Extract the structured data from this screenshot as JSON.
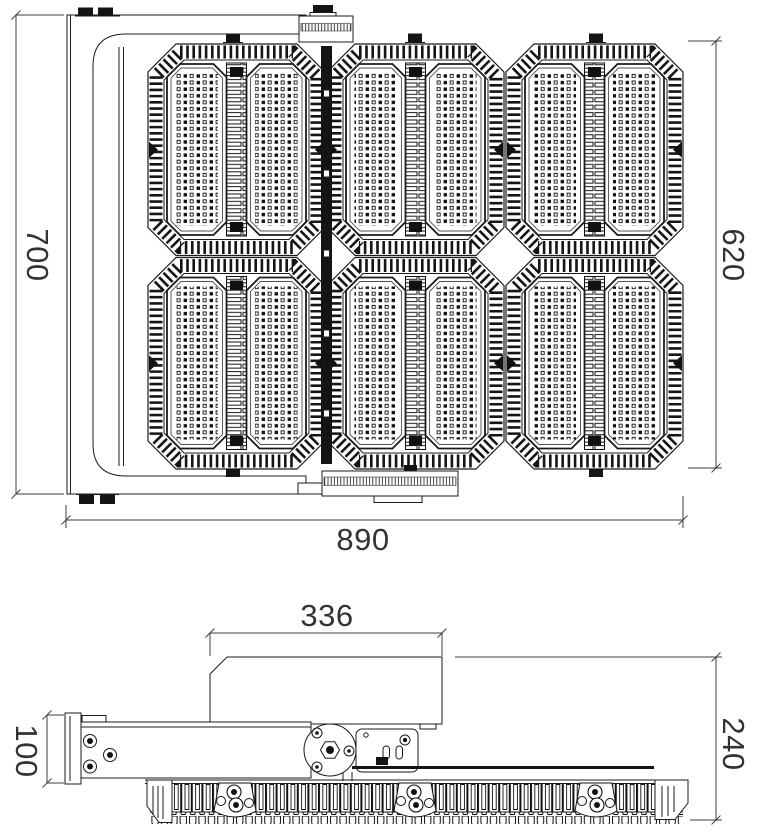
{
  "dimensions": {
    "front": {
      "overall_height": "700",
      "body_height": "620",
      "overall_width": "890"
    },
    "side": {
      "driver_box_width": "336",
      "arm_height": "100",
      "overall_depth": "240"
    }
  }
}
